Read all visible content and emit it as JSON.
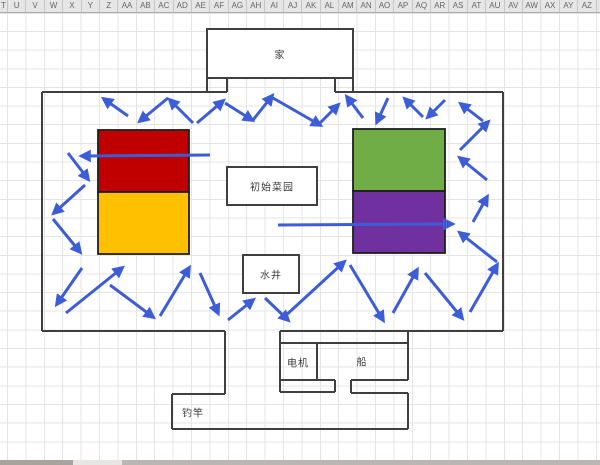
{
  "spreadsheet": {
    "columns": [
      "T",
      "U",
      "V",
      "W",
      "X",
      "Y",
      "Z",
      "AA",
      "AB",
      "AC",
      "AD",
      "AE",
      "AF",
      "AG",
      "AH",
      "AI",
      "AJ",
      "AK",
      "AL",
      "AM",
      "AN",
      "AO",
      "AP",
      "AQ",
      "AR",
      "AS",
      "AT",
      "AU",
      "AV",
      "AW",
      "AX",
      "AY",
      "AZ",
      "BA"
    ]
  },
  "colors": {
    "header_bg": "#e6e6e6",
    "header_text": "#666666",
    "header_border": "#ababab",
    "grid_line": "#e4e4e4",
    "wall": "#3f3f3f",
    "box_border": "#1f1f1f",
    "arrow_blue": "#3d5cd7",
    "red": "#c00000",
    "yellow": "#ffc000",
    "green": "#70ad47",
    "purple": "#7030a0",
    "white": "#ffffff",
    "label_text": "#3a3a3a",
    "bar_dark": "#a8a49d",
    "bar_light": "#e8e6e3",
    "bar_mid": "#bab7b2"
  },
  "diagram": {
    "labels": [
      {
        "id": "home",
        "text": "家",
        "x": 280,
        "y": 54
      },
      {
        "id": "initial-garden",
        "text": "初始菜园",
        "x": 272,
        "y": 186
      },
      {
        "id": "well",
        "text": "水井",
        "x": 271,
        "y": 274
      },
      {
        "id": "motor",
        "text": "电机",
        "x": 298,
        "y": 362
      },
      {
        "id": "boat",
        "text": "船",
        "x": 362,
        "y": 361
      },
      {
        "id": "fishing-rod",
        "text": "钓竿",
        "x": 193,
        "y": 412
      }
    ],
    "rooms": [
      {
        "id": "home-room",
        "x": 207,
        "y": 29,
        "w": 146,
        "h": 49
      },
      {
        "id": "initial-garden-box",
        "x": 227,
        "y": 167,
        "w": 90,
        "h": 38
      },
      {
        "id": "well-box",
        "x": 243,
        "y": 255,
        "w": 56,
        "h": 38
      }
    ],
    "colored_boxes": [
      {
        "id": "red-box",
        "x": 98,
        "y": 130,
        "w": 91,
        "h": 62,
        "color": "red"
      },
      {
        "id": "yellow-box",
        "x": 98,
        "y": 192,
        "w": 91,
        "h": 62,
        "color": "yellow"
      },
      {
        "id": "green-box",
        "x": 353,
        "y": 129,
        "w": 92,
        "h": 62,
        "color": "green"
      },
      {
        "id": "purple-box",
        "x": 353,
        "y": 191,
        "w": 92,
        "h": 62,
        "color": "purple"
      }
    ],
    "walls": [
      [
        207,
        78,
        207,
        92
      ],
      [
        227,
        78,
        227,
        92
      ],
      [
        335,
        78,
        335,
        92
      ],
      [
        353,
        78,
        353,
        92
      ],
      [
        42,
        92,
        227,
        92
      ],
      [
        335,
        92,
        503,
        92
      ],
      [
        42,
        92,
        42,
        331
      ],
      [
        503,
        92,
        503,
        331
      ],
      [
        42,
        331,
        225,
        331
      ],
      [
        280,
        331,
        503,
        331
      ],
      [
        225,
        331,
        225,
        394
      ],
      [
        280,
        331,
        280,
        392
      ],
      [
        172,
        394,
        225,
        394
      ],
      [
        172,
        394,
        172,
        429
      ],
      [
        172,
        429,
        408,
        429
      ],
      [
        408,
        393,
        408,
        429
      ],
      [
        280,
        343,
        408,
        343
      ],
      [
        408,
        331,
        408,
        380
      ],
      [
        317,
        343,
        317,
        380
      ],
      [
        280,
        380,
        335,
        380
      ],
      [
        335,
        380,
        335,
        392
      ],
      [
        280,
        392,
        335,
        392
      ],
      [
        351,
        380,
        408,
        380
      ],
      [
        351,
        380,
        351,
        393
      ],
      [
        351,
        393,
        408,
        393
      ]
    ],
    "long_arrows": [
      {
        "id": "route-long-left",
        "x1": 210,
        "y1": 155,
        "x2": 82,
        "y2": 156
      },
      {
        "id": "route-long-right",
        "x1": 278,
        "y1": 225,
        "x2": 452,
        "y2": 224
      }
    ],
    "arrows": [
      [
        128,
        116,
        104,
        99
      ],
      [
        68,
        153,
        88,
        179
      ],
      [
        85,
        185,
        54,
        213
      ],
      [
        53,
        219,
        80,
        252
      ],
      [
        82,
        268,
        57,
        304
      ],
      [
        66,
        313,
        122,
        268
      ],
      [
        168,
        98,
        140,
        121
      ],
      [
        193,
        123,
        170,
        100
      ],
      [
        197,
        123,
        223,
        101
      ],
      [
        225,
        103,
        252,
        120
      ],
      [
        253,
        120,
        272,
        96
      ],
      [
        273,
        98,
        320,
        125
      ],
      [
        318,
        125,
        338,
        105
      ],
      [
        363,
        118,
        347,
        97
      ],
      [
        388,
        98,
        377,
        122
      ],
      [
        423,
        117,
        405,
        99
      ],
      [
        445,
        100,
        428,
        117
      ],
      [
        483,
        121,
        461,
        104
      ],
      [
        460,
        150,
        488,
        122
      ],
      [
        487,
        180,
        460,
        158
      ],
      [
        473,
        222,
        487,
        197
      ],
      [
        497,
        262,
        460,
        233
      ],
      [
        470,
        312,
        497,
        265
      ],
      [
        110,
        285,
        153,
        317
      ],
      [
        160,
        316,
        189,
        268
      ],
      [
        200,
        273,
        218,
        313
      ],
      [
        228,
        320,
        253,
        300
      ],
      [
        265,
        298,
        288,
        320
      ],
      [
        283,
        318,
        344,
        262
      ],
      [
        350,
        265,
        383,
        320
      ],
      [
        393,
        313,
        417,
        270
      ],
      [
        425,
        273,
        462,
        318
      ]
    ],
    "bottom_bar": [
      {
        "x": 0,
        "w": 73,
        "color": "bar_dark"
      },
      {
        "x": 73,
        "w": 49,
        "color": "bar_light"
      },
      {
        "x": 122,
        "w": 478,
        "color": "bar_mid"
      }
    ]
  }
}
